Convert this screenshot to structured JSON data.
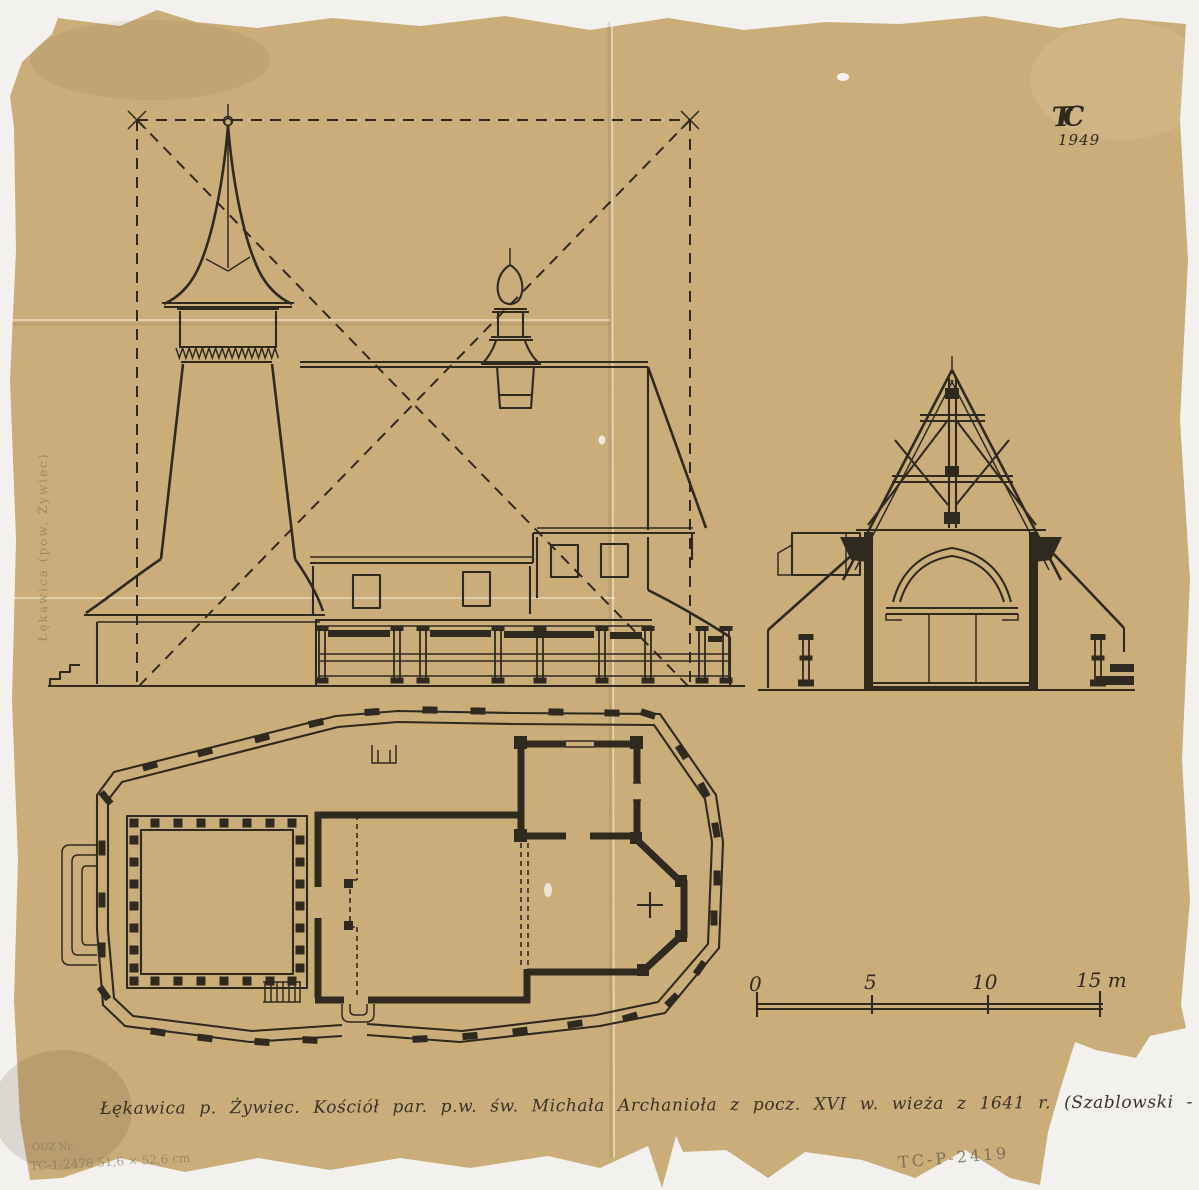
{
  "sheet": {
    "background_color": "#f2f1ed",
    "paper_color": "#c9ae79",
    "ink_color": "#2f2a20",
    "monogram": {
      "initials": "TC",
      "year": "1949"
    },
    "caption": "Łękawica p. Żywiec. Kościół par. p.w. św. Michała Archanioła z pocz. XVI w. wieża z 1641 r. (Szablowski - Powiat Żywiecki -",
    "margin_note_vertical": "Łękawica (pow. Żywiec)",
    "pencil_notes": {
      "bottom_left_line1": "OUZ Nr",
      "bottom_left_line2": "TC-1-2478   51,6 × 52,6 cm",
      "bottom_right": "TC-P-2419"
    },
    "scale_bar": {
      "labels": [
        "0",
        "5",
        "10",
        "15 m"
      ]
    }
  }
}
